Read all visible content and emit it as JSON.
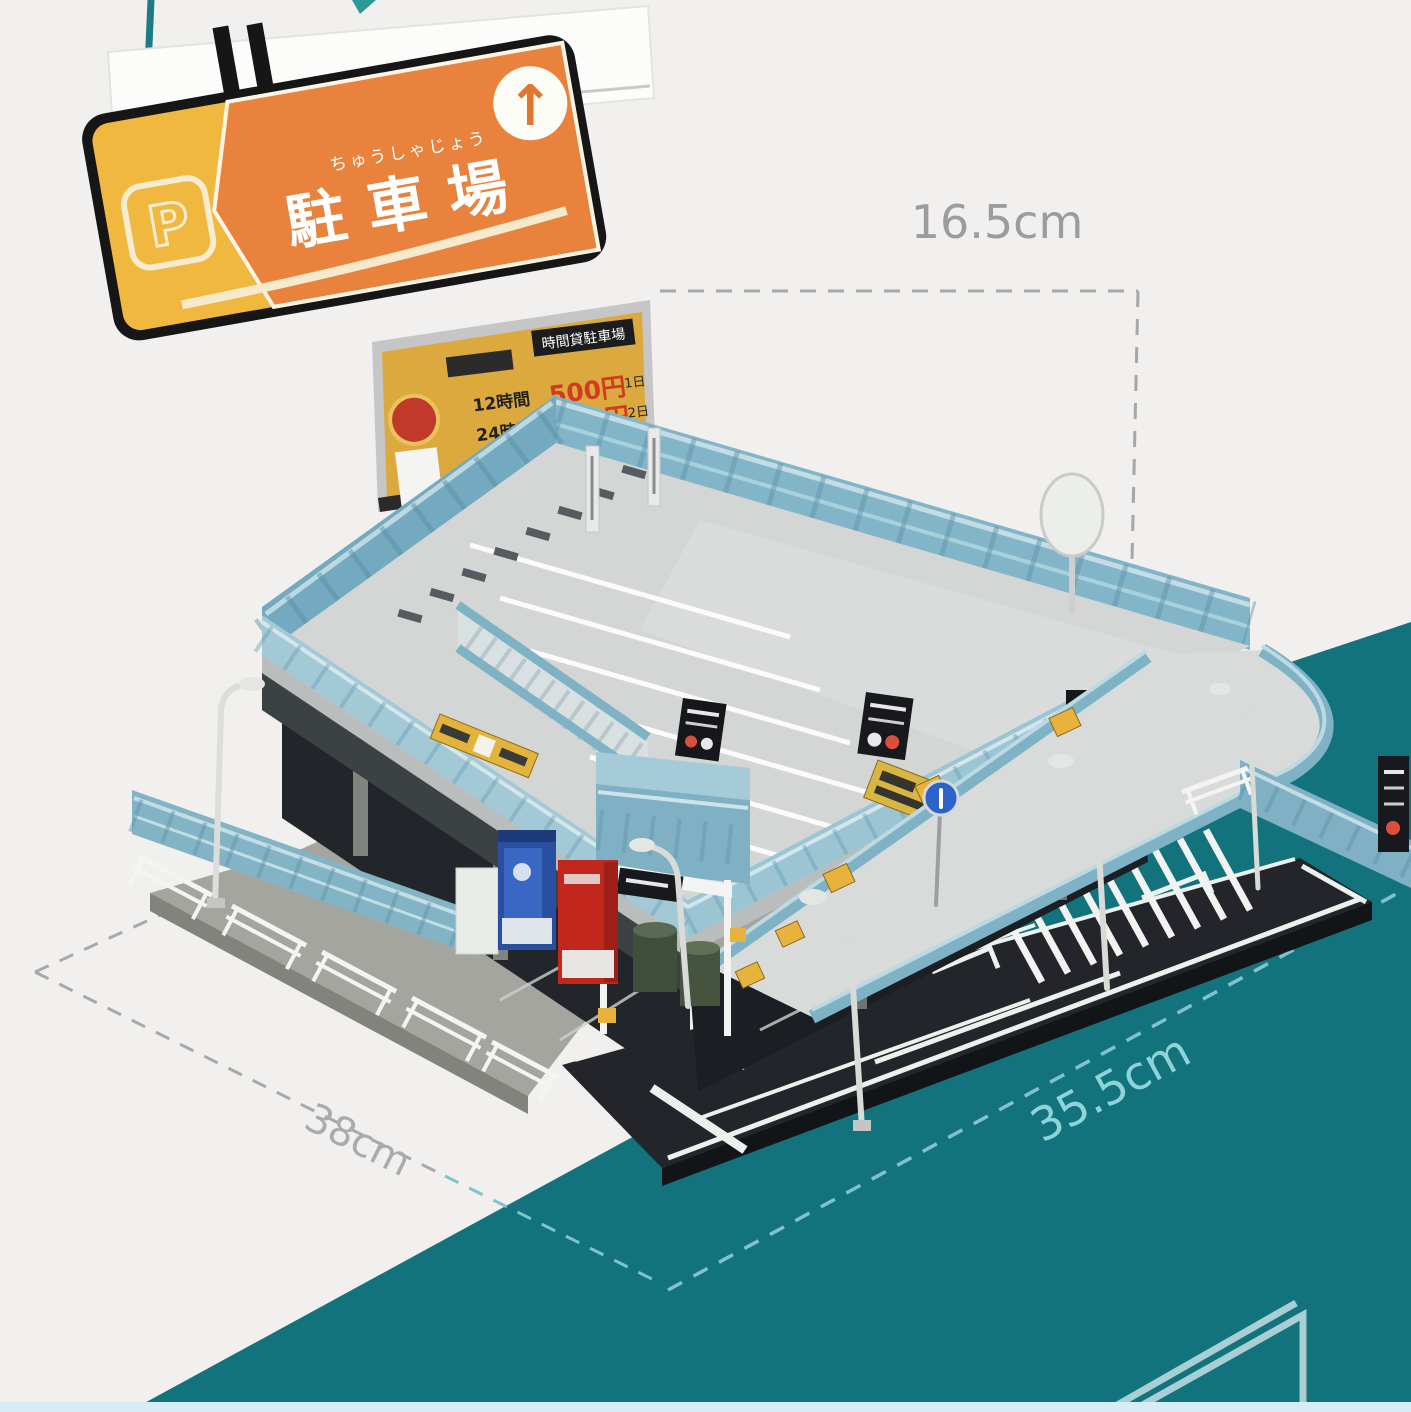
{
  "image_type": "product photo of a miniature Japanese parking-garage diorama model with dimension callouts",
  "colors": {
    "background": "#f1f0ee",
    "accent_teal": "#12737d",
    "sign_orange": "#e8823c",
    "sign_yellow": "#f0b83f",
    "fence_blue": "#85b7c9",
    "road_black": "#23252a",
    "price_red": "#d23a22",
    "dimension_gray": "#a3a3a3",
    "dimension_teal": "#8fd3da"
  },
  "hanging_sign": {
    "main_text": "駐車場",
    "furigana": "ちゅうしゃじょう",
    "symbol": "P",
    "arrow": "↑"
  },
  "billboard": {
    "header": "時間貸駐車場",
    "rows": [
      {
        "duration": "12時間",
        "price": "500円",
        "per": "1日"
      },
      {
        "duration": "24時間",
        "price": "800円",
        "per": "2日"
      }
    ]
  },
  "road_marking": {
    "text": "止まれ",
    "chars": [
      "れ",
      "ま",
      "止"
    ]
  },
  "dimensions": {
    "height_label": "16.5cm",
    "left_label": "38cm",
    "right_label": "35.5cm"
  }
}
